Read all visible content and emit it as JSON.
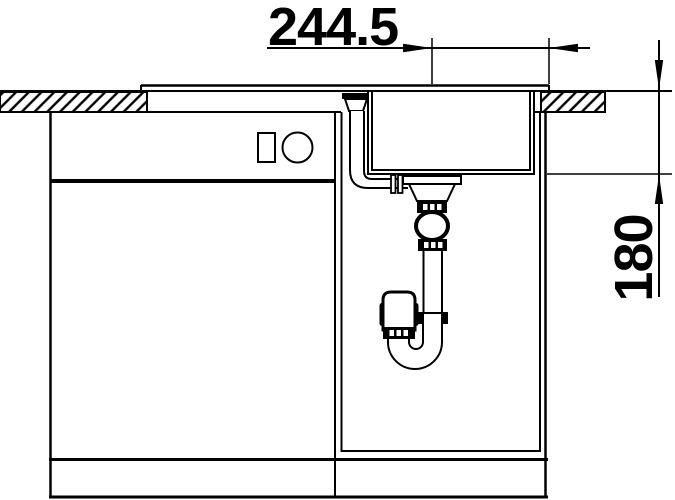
{
  "drawing": {
    "type": "technical-cross-section",
    "background_color": "#ffffff",
    "line_color": "#000000",
    "dimensions": {
      "horizontal": {
        "label": "244.5"
      },
      "vertical": {
        "label": "180"
      }
    }
  }
}
